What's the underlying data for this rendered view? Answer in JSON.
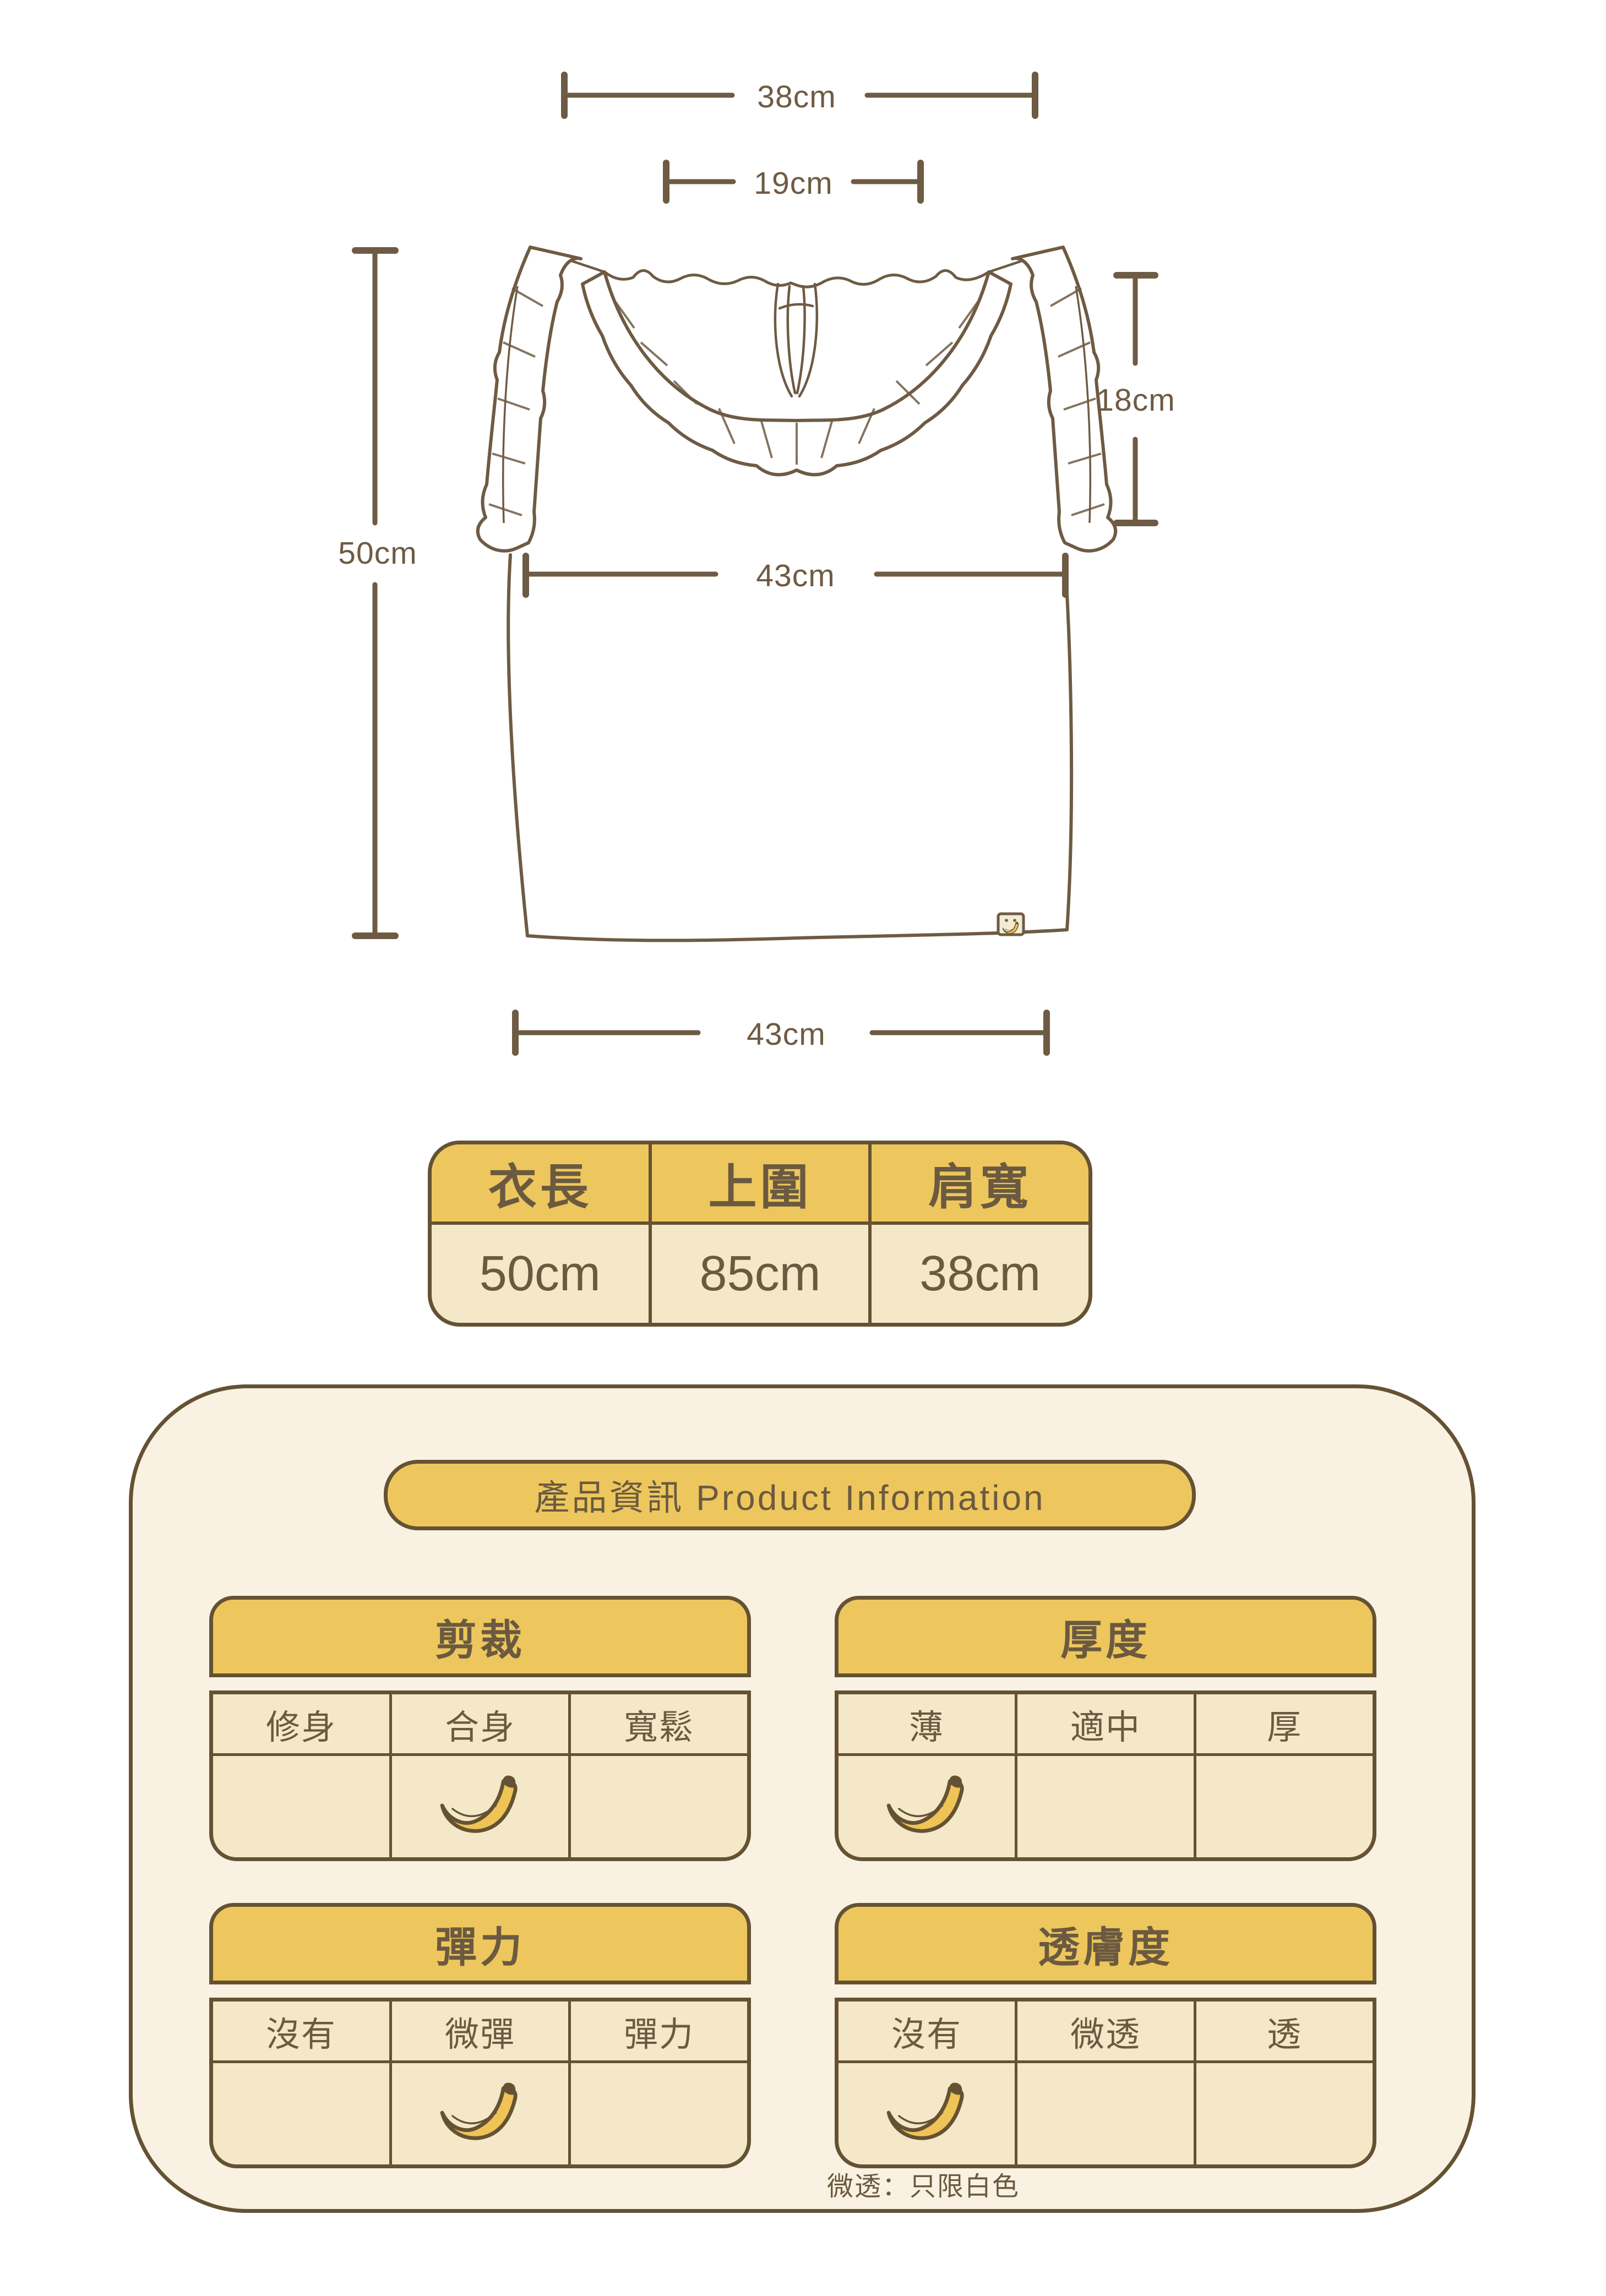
{
  "colors": {
    "accent_yellow": "#EDC75D",
    "border_brown": "#645233",
    "text_brown": "#6B5A40",
    "cell_cream": "#F4E8C8",
    "panel_cream": "#F9F2E2",
    "banana_yellow": "#EFC355"
  },
  "diagram": {
    "shoulder_width_label": "38cm",
    "neck_width_label": "19cm",
    "armhole_label": "18cm",
    "length_label": "50cm",
    "chest_label": "43cm",
    "hem_label": "43cm"
  },
  "size_table": {
    "headers": [
      "衣長",
      "上圍",
      "肩寬"
    ],
    "values": [
      "50cm",
      "85cm",
      "38cm"
    ]
  },
  "product_info": {
    "title": "產品資訊 Product Information",
    "tables": [
      {
        "title": "剪裁",
        "options": [
          "修身",
          "合身",
          "寬鬆"
        ],
        "selected": "合身"
      },
      {
        "title": "厚度",
        "options": [
          "薄",
          "適中",
          "厚"
        ],
        "selected": "薄"
      },
      {
        "title": "彈力",
        "options": [
          "沒有",
          "微彈",
          "彈力"
        ],
        "selected": "微彈"
      },
      {
        "title": "透膚度",
        "options": [
          "沒有",
          "微透",
          "透"
        ],
        "selected": "沒有"
      }
    ],
    "note": "微透：只限白色"
  }
}
